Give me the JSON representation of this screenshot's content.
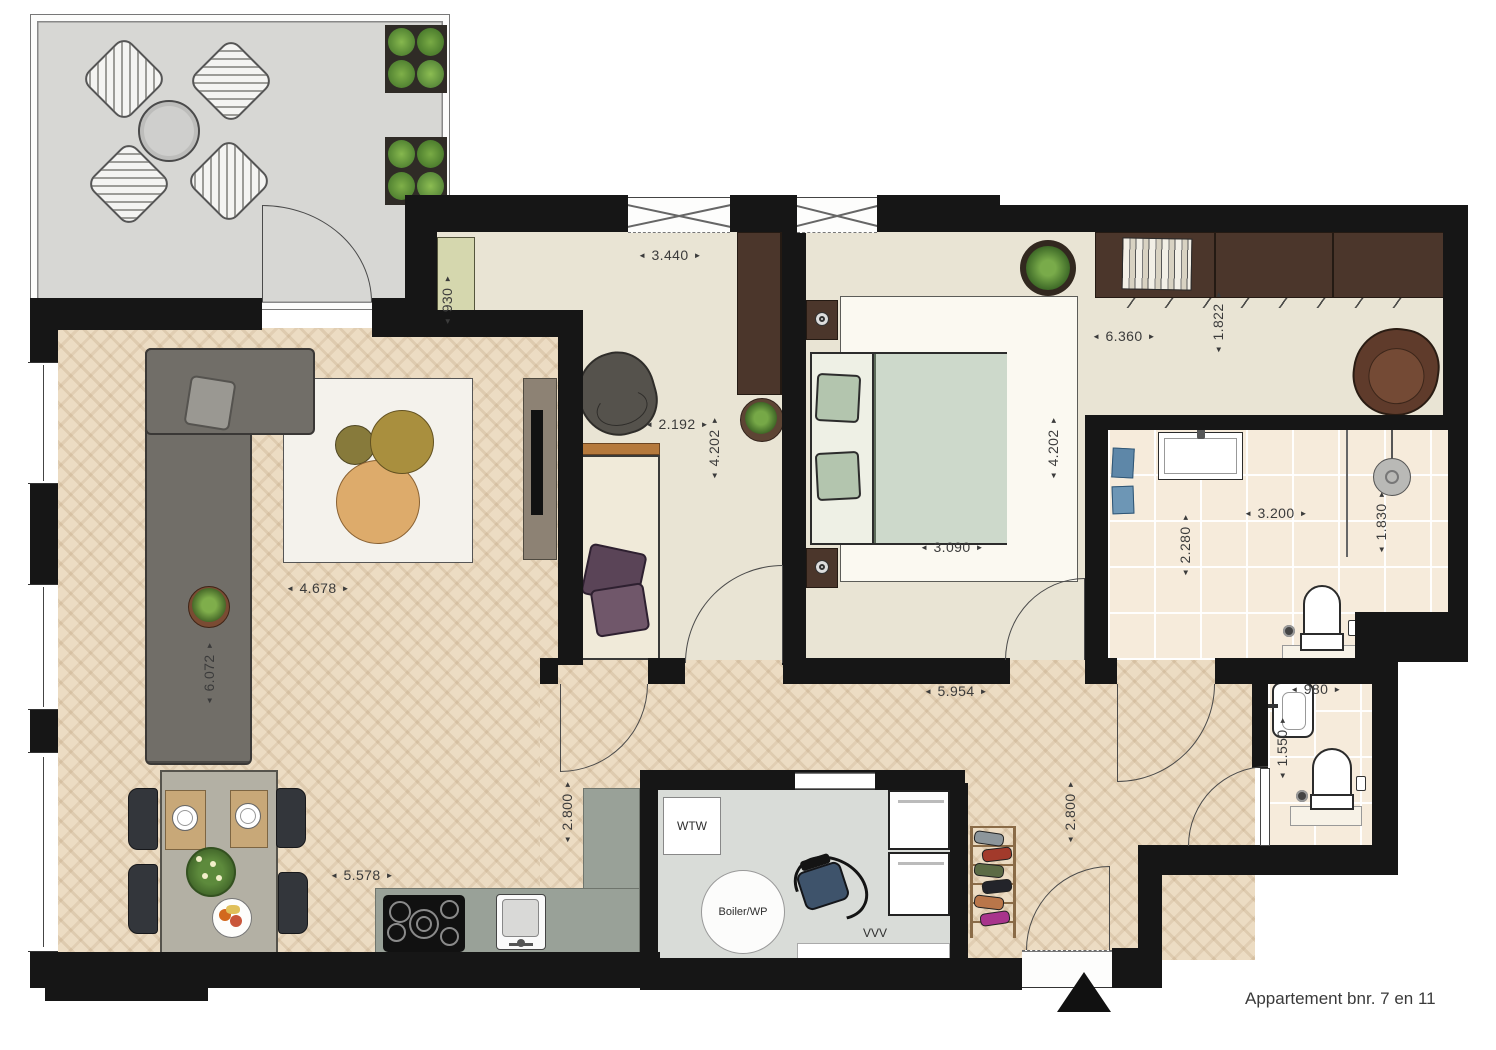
{
  "title": "Appartement bnr. 7 en 11",
  "technical_labels": {
    "heat_recovery": "WTW",
    "boiler": "Boiler/WP",
    "ventilation": "VVV"
  },
  "dimensions": {
    "study_top_width": "3.440",
    "cabinet_width": "930",
    "dressing_width": "6.360",
    "wardrobe_depth": "1.822",
    "study_width": "2.192",
    "study_depth": "4.202",
    "bedroom_depth": "4.202",
    "bedroom_width": "3.090",
    "bathroom_width": "3.200",
    "bathroom_depth": "2.280",
    "shower_zone_depth": "1.830",
    "living_width": "4.678",
    "living_depth": "6.072",
    "hallway_width": "5.954",
    "toilet_width": "980",
    "toilet_depth": "1.550",
    "kitchen_zone_depth": "2.800",
    "hall_zone_depth": "2.800",
    "kitchen_width": "5.578"
  },
  "colors": {
    "wall": "#161616",
    "wood_floor": "#ecdcc3",
    "carpet": "#e9e4d4",
    "tile": "#f6ebdb",
    "terrace_concrete": "#d7d7d4",
    "kitchen_counter": "#99a198",
    "cabinet_green": "#d5d7ae",
    "wardrobe_brown": "#4b362b",
    "bed_green": "#cdd9cb"
  }
}
